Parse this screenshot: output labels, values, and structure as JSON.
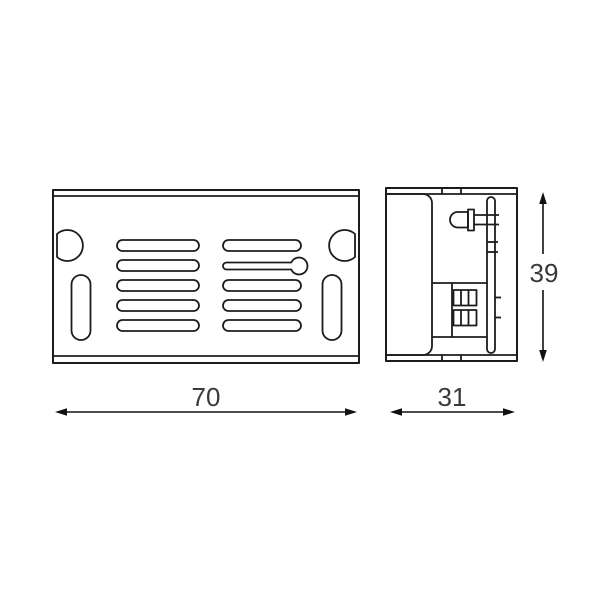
{
  "dimensions": {
    "width": {
      "label": "70"
    },
    "depth": {
      "label": "31"
    },
    "height": {
      "label": "39"
    }
  },
  "colors": {
    "background": "#ffffff",
    "line": "#1c1c1c",
    "dimension": "#111111",
    "text": "#3a3a3a"
  }
}
